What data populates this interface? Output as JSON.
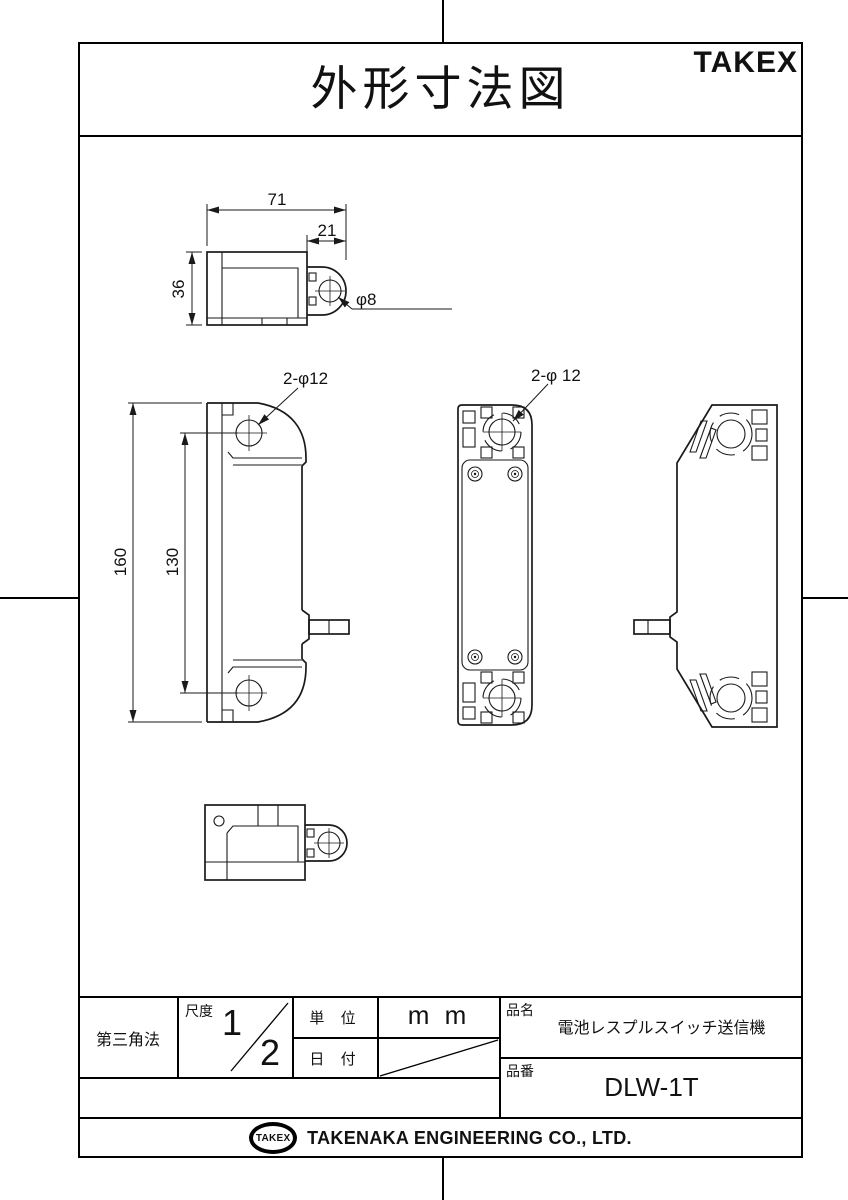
{
  "header": {
    "title": "外形寸法図",
    "brand": "TAKEX"
  },
  "dimensions": {
    "top_view": {
      "width": "71",
      "eyelet_width": "21",
      "height": "36",
      "hole": "φ8"
    },
    "side_view": {
      "height": "160",
      "hole_pitch": "130",
      "holes": "2-φ12"
    },
    "front_view": {
      "holes": "2-φ 12"
    }
  },
  "title_block": {
    "projection": "第三角法",
    "scale_label": "尺度",
    "scale_numerator": "1",
    "scale_denominator": "2",
    "unit_label": "単 位",
    "unit_value": "m m",
    "date_label": "日 付",
    "product_name_label": "品名",
    "product_name": "電池レスプルスイッチ送信機",
    "part_number_label": "品番",
    "part_number": "DLW-1T"
  },
  "footer": {
    "logo_text": "TAKEX",
    "company": "TAKENAKA ENGINEERING CO., LTD."
  }
}
